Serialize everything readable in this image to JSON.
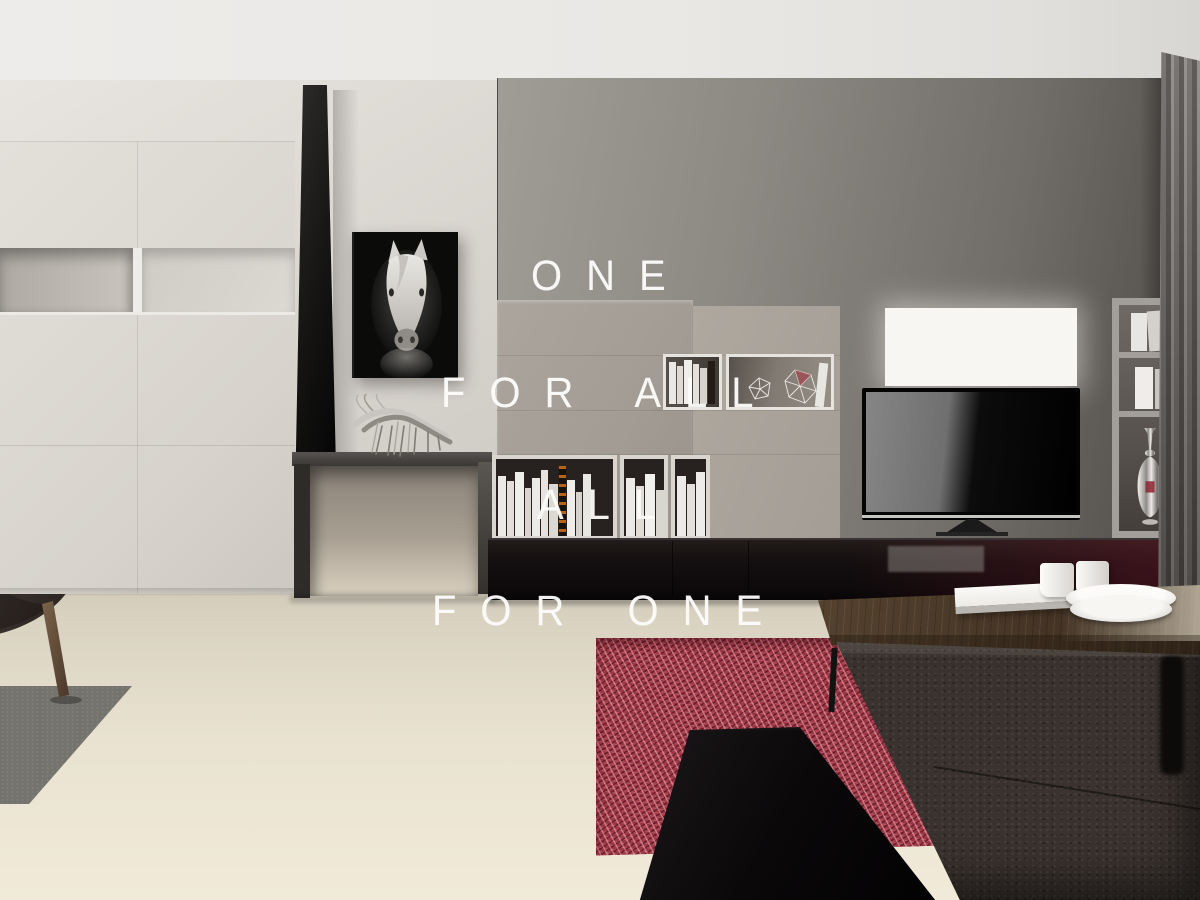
{
  "overlay_text": {
    "line1": "ONE",
    "line2": "FOR ALL",
    "line3": "ALL",
    "line4": "FOR ONE",
    "color": "#ffffff"
  },
  "scene": {
    "type": "interior-3d-render",
    "room": "modern-living-room",
    "objects": [
      "white-cabinet-wall",
      "open-wall-niche",
      "black-wall-panel",
      "horse-portrait-artwork",
      "silver-horse-sculpture",
      "dark-console-table",
      "taupe-wall-unit",
      "open-book-niches",
      "wireframe-polyhedra-decor",
      "bookshelf-with-white-books",
      "black-gloss-base-cabinet",
      "backlit-white-panel",
      "flatscreen-tv",
      "tall-open-shelf",
      "silver-vase",
      "grey-curtain",
      "red-shag-rug",
      "grey-floor-mat",
      "dark-armchair",
      "black-gloss-bench",
      "wooden-coffee-table",
      "white-book",
      "white-cups",
      "white-plates",
      "dark-leather-sofa",
      "cream-floor"
    ],
    "palette": {
      "accent_rug_red": "#9c3845",
      "wall_grey": "#8d8983",
      "wall_white": "#d8d4ce",
      "cabinet_taupe": "#a8a29a",
      "floor_cream": "#e9e2d1",
      "gloss_black": "#120d0f",
      "wood_walnut": "#4a3a2c",
      "metal_silver": "#c7c4bf"
    }
  }
}
